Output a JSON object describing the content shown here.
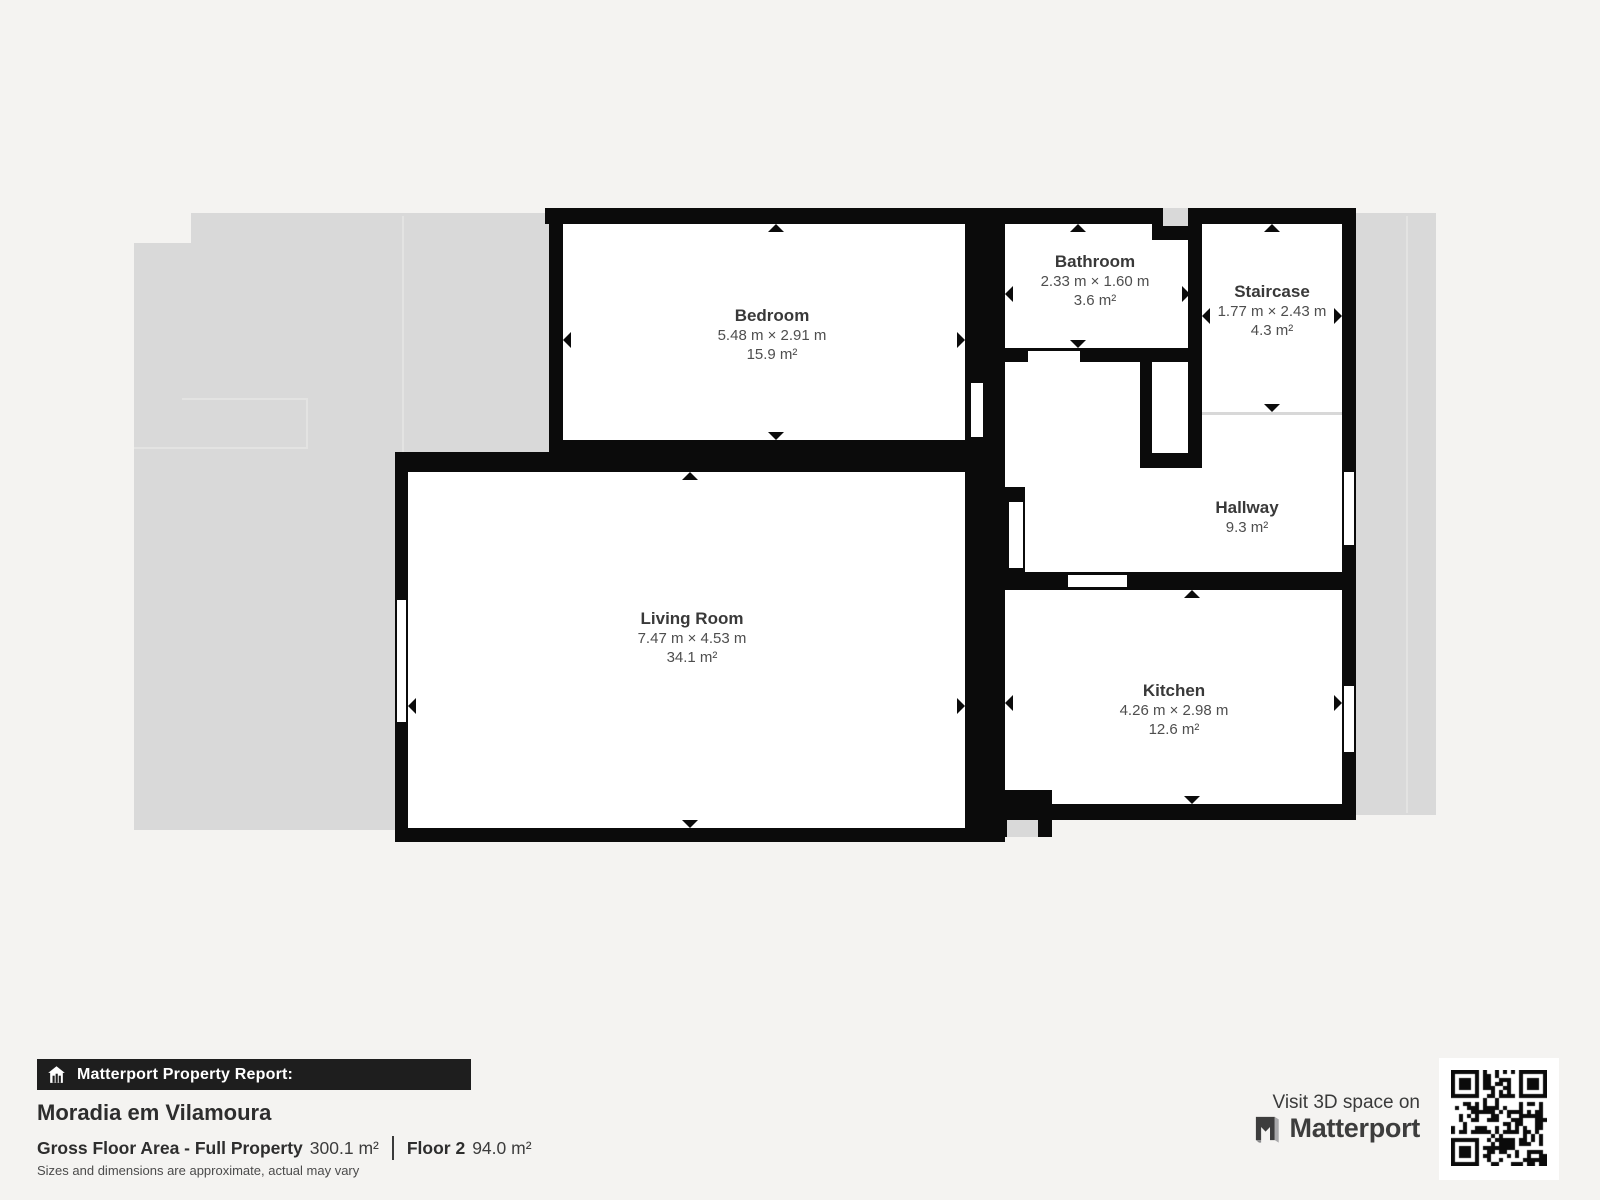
{
  "colors": {
    "page": "#f4f3f1",
    "underlay": "#d9d9d9",
    "wall": "#0b0b0b",
    "banner_bg": "#1e1e1e"
  },
  "floorplan": {
    "rooms": [
      {
        "name": "Bedroom",
        "dimensions": "5.48 m × 2.91 m",
        "area": "15.9 m²"
      },
      {
        "name": "Bathroom",
        "dimensions": "2.33 m × 1.60 m",
        "area": "3.6 m²"
      },
      {
        "name": "Staircase",
        "dimensions": "1.77 m × 2.43 m",
        "area": "4.3 m²"
      },
      {
        "name": "Hallway",
        "dimensions": "",
        "area": "9.3 m²"
      },
      {
        "name": "Living Room",
        "dimensions": "7.47 m × 4.53 m",
        "area": "34.1 m²"
      },
      {
        "name": "Kitchen",
        "dimensions": "4.26 m × 2.98 m",
        "area": "12.6 m²"
      }
    ]
  },
  "report": {
    "banner": "Matterport Property Report:",
    "property_name": "Moradia em Vilamoura",
    "gross_label": "Gross Floor Area - Full Property",
    "gross_value": "300.1 m²",
    "floor_label": "Floor 2",
    "floor_value": "94.0 m²",
    "disclaimer": "Sizes and dimensions are approximate, actual may vary"
  },
  "cta": {
    "visit_text": "Visit 3D space on",
    "brand": "Matterport"
  }
}
